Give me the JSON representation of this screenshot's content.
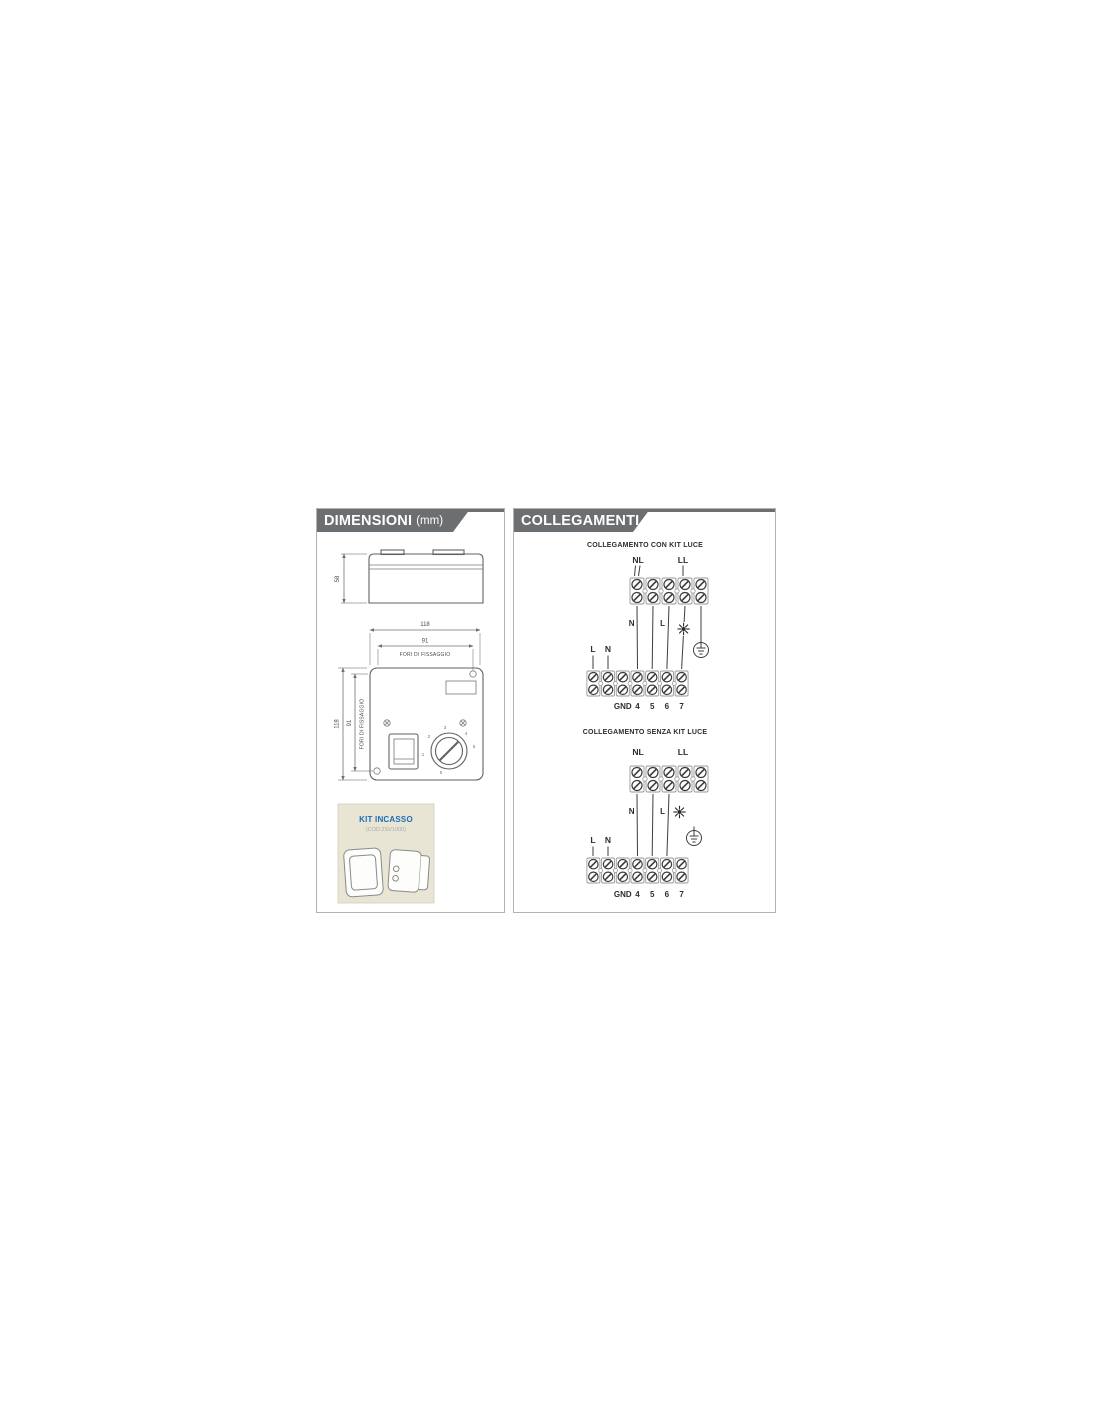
{
  "colors": {
    "header_bg": "#6c6f72",
    "kit_bg": "#e9e5d5",
    "kit_title_blue": "#1a6db6",
    "line": "#3c3e40"
  },
  "dimensioni": {
    "header": "DIMENSIONI",
    "unit": "(mm)",
    "depth": "58",
    "width_top": "118",
    "hole_top": "91",
    "fori_top": "FORI DI FISSAGGIO",
    "height_left": "118",
    "hole_left": "91",
    "fori_left": "FORI DI FISSAGGIO",
    "knob": [
      "0",
      "1",
      "2",
      "3",
      "4",
      "5"
    ],
    "kit_title": "KIT INCASSO",
    "kit_code": "(COD.2SV1000)"
  },
  "collegamenti": {
    "header": "COLLEGAMENTI",
    "con": {
      "title": "COLLEGAMENTO CON KIT LUCE",
      "nl": "NL",
      "ll": "LL",
      "wire_n": "N",
      "wire_l": "L",
      "in_l": "L",
      "in_n": "N",
      "gnd": "GND",
      "t4": "4",
      "t5": "5",
      "t6": "6",
      "t7": "7"
    },
    "senza": {
      "title": "COLLEGAMENTO SENZA KIT LUCE",
      "nl": "NL",
      "ll": "LL",
      "wire_n": "N",
      "wire_l": "L",
      "in_l": "L",
      "in_n": "N",
      "gnd": "GND",
      "t4": "4",
      "t5": "5",
      "t6": "6",
      "t7": "7"
    }
  }
}
